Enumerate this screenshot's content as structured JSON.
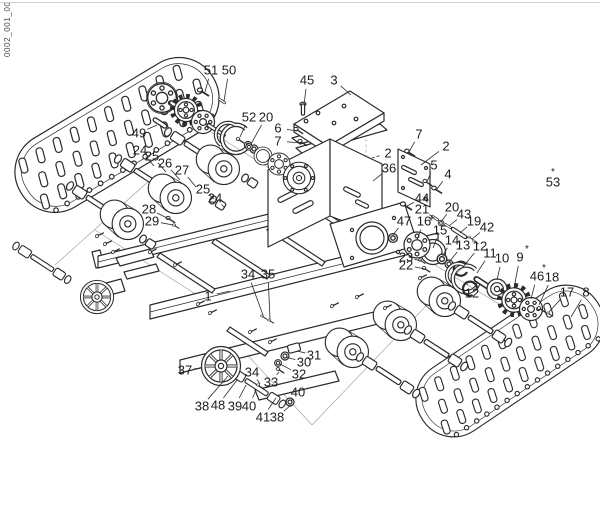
{
  "page": {
    "background": "#ffffff",
    "line_color": "#2b2b2b",
    "scan_edge_color": "#d0d0d0",
    "sheet_code": "0002_001_00"
  },
  "diagram": {
    "labels": [
      {
        "t": "51",
        "x": 211,
        "y": 70,
        "tx": 205,
        "ty": 92
      },
      {
        "t": "50",
        "x": 229,
        "y": 70,
        "tx": 224,
        "ty": 101
      },
      {
        "t": "45",
        "x": 307,
        "y": 80,
        "tx": 304,
        "ty": 105
      },
      {
        "t": "3",
        "x": 334,
        "y": 80,
        "tx": 351,
        "ty": 95
      },
      {
        "t": "52",
        "x": 249,
        "y": 117,
        "tx": 240,
        "ty": 137
      },
      {
        "t": "20",
        "x": 266,
        "y": 117,
        "tx": 251,
        "ty": 144
      },
      {
        "t": "6",
        "x": 278,
        "y": 128,
        "tx": 297,
        "ty": 131
      },
      {
        "t": "7",
        "x": 278,
        "y": 141,
        "tx": 301,
        "ty": 143
      },
      {
        "t": "49",
        "x": 139,
        "y": 133,
        "tx": 157,
        "ty": 125
      },
      {
        "t": "24",
        "x": 140,
        "y": 150,
        "tx": 154,
        "ty": 166
      },
      {
        "t": "25",
        "x": 152,
        "y": 156,
        "tx": 166,
        "ty": 172
      },
      {
        "t": "26",
        "x": 165,
        "y": 163,
        "tx": 180,
        "ty": 180
      },
      {
        "t": "27",
        "x": 182,
        "y": 170,
        "tx": 196,
        "ty": 187
      },
      {
        "t": "25",
        "x": 203,
        "y": 189,
        "tx": 214,
        "ty": 199
      },
      {
        "t": "24",
        "x": 215,
        "y": 198,
        "tx": 225,
        "ty": 208
      },
      {
        "t": "28",
        "x": 149,
        "y": 209,
        "tx": 169,
        "ty": 219
      },
      {
        "t": "29",
        "x": 152,
        "y": 221,
        "tx": 173,
        "ty": 225
      },
      {
        "t": "7",
        "x": 419,
        "y": 134,
        "tx": 409,
        "ty": 152
      },
      {
        "t": "2",
        "x": 446,
        "y": 146,
        "tx": 421,
        "ty": 165
      },
      {
        "t": "2",
        "x": 388,
        "y": 153,
        "tx": 372,
        "ty": 158,
        "dash": true
      },
      {
        "t": "36",
        "x": 389,
        "y": 168,
        "tx": 373,
        "ty": 181
      },
      {
        "t": "5",
        "x": 434,
        "y": 165,
        "tx": 427,
        "ty": 182
      },
      {
        "t": "4",
        "x": 448,
        "y": 174,
        "tx": 437,
        "ty": 189
      },
      {
        "t": "53",
        "x": 553,
        "y": 182,
        "star": true,
        "sdx": 0,
        "sdy": -7
      },
      {
        "t": "44",
        "x": 422,
        "y": 198,
        "tx": 407,
        "ty": 206
      },
      {
        "t": "21",
        "x": 422,
        "y": 209,
        "tx": 434,
        "ty": 218
      },
      {
        "t": "20",
        "x": 452,
        "y": 207,
        "tx": 441,
        "ty": 222
      },
      {
        "t": "43",
        "x": 464,
        "y": 214,
        "tx": 449,
        "ty": 226
      },
      {
        "t": "19",
        "x": 474,
        "y": 221,
        "tx": 460,
        "ty": 233
      },
      {
        "t": "42",
        "x": 487,
        "y": 227,
        "tx": 472,
        "ty": 239
      },
      {
        "t": "47",
        "x": 404,
        "y": 221,
        "tx": 393,
        "ty": 235
      },
      {
        "t": "16",
        "x": 424,
        "y": 221,
        "tx": 417,
        "ty": 240
      },
      {
        "t": "15",
        "x": 440,
        "y": 230,
        "star": true,
        "sdx": -9,
        "sdy": -6,
        "tx": 433,
        "ty": 248
      },
      {
        "t": "14",
        "x": 452,
        "y": 240,
        "tx": 442,
        "ty": 257
      },
      {
        "t": "13",
        "x": 463,
        "y": 245,
        "tx": 449,
        "ty": 262
      },
      {
        "t": "12",
        "x": 480,
        "y": 246,
        "tx": 463,
        "ty": 267
      },
      {
        "t": "11",
        "x": 490,
        "y": 253,
        "tx": 477,
        "ty": 273
      },
      {
        "t": "10",
        "x": 502,
        "y": 258,
        "tx": 497,
        "ty": 280
      },
      {
        "t": "9",
        "x": 520,
        "y": 257,
        "star": true,
        "tx": 514,
        "ty": 288
      },
      {
        "t": "23",
        "x": 406,
        "y": 257,
        "tx": 421,
        "ty": 261
      },
      {
        "t": "22",
        "x": 406,
        "y": 265,
        "tx": 425,
        "ty": 269
      },
      {
        "t": "46",
        "x": 537,
        "y": 276,
        "star": true,
        "tx": 531,
        "ty": 299
      },
      {
        "t": "18",
        "x": 552,
        "y": 277,
        "tx": 539,
        "ty": 305
      },
      {
        "t": "17",
        "x": 567,
        "y": 292,
        "tx": 549,
        "ty": 312
      },
      {
        "t": "8",
        "x": 586,
        "y": 292,
        "tx": 571,
        "ty": 317
      },
      {
        "t": "12",
        "x": 472,
        "y": 293,
        "tx": 467,
        "ty": 284
      },
      {
        "t": "34",
        "x": 248,
        "y": 274,
        "tx": 263,
        "ty": 315
      },
      {
        "t": "35",
        "x": 268,
        "y": 274,
        "tx": 270,
        "ty": 319
      },
      {
        "t": "1",
        "x": 208,
        "y": 296,
        "tx": 230,
        "ty": 291
      },
      {
        "t": "37",
        "x": 185,
        "y": 370,
        "tx": 202,
        "ty": 368
      },
      {
        "t": "31",
        "x": 314,
        "y": 355,
        "tx": 297,
        "ty": 351
      },
      {
        "t": "30",
        "x": 304,
        "y": 362,
        "tx": 286,
        "ty": 357
      },
      {
        "t": "32",
        "x": 299,
        "y": 374,
        "tx": 280,
        "ty": 364
      },
      {
        "t": "34",
        "x": 252,
        "y": 372,
        "tx": 260,
        "ty": 384
      },
      {
        "t": "33",
        "x": 271,
        "y": 382,
        "tx": 279,
        "ty": 372
      },
      {
        "t": "40",
        "x": 298,
        "y": 392,
        "tx": 291,
        "ty": 401
      },
      {
        "t": "38",
        "x": 202,
        "y": 406,
        "tx": 228,
        "ty": 376
      },
      {
        "t": "48",
        "x": 218,
        "y": 405,
        "tx": 237,
        "ty": 380
      },
      {
        "t": "39",
        "x": 235,
        "y": 406,
        "tx": 246,
        "ty": 385
      },
      {
        "t": "40",
        "x": 249,
        "y": 406,
        "tx": 256,
        "ty": 390
      },
      {
        "t": "41",
        "x": 263,
        "y": 417,
        "tx": 276,
        "ty": 398
      },
      {
        "t": "38",
        "x": 277,
        "y": 417,
        "tx": 291,
        "ty": 405
      }
    ]
  }
}
